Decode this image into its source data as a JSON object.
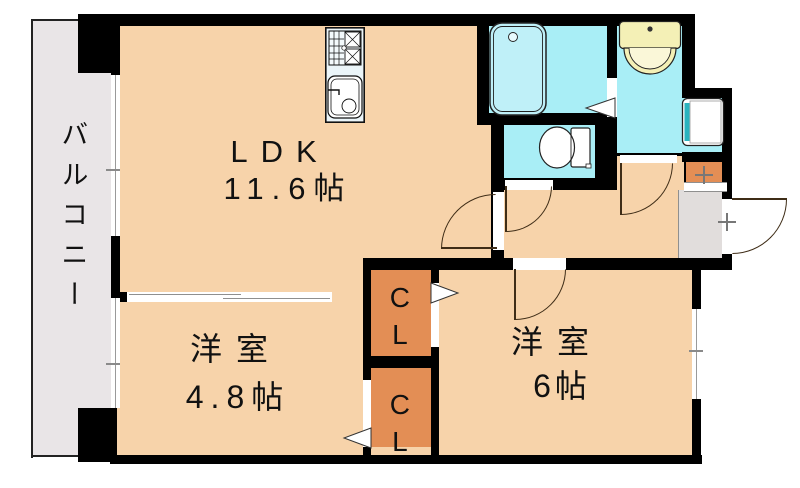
{
  "document": {
    "type": "floor-plan"
  },
  "rooms": {
    "balcony": {
      "label": "バルコニー"
    },
    "ldk": {
      "label": "LDK",
      "size": "11.6帖"
    },
    "bedroom_west": {
      "label": "洋室",
      "size": "4.8帖"
    },
    "bedroom_east": {
      "label": "洋室",
      "size": "6帖"
    },
    "closet_upper": {
      "label": "CL"
    },
    "closet_lower": {
      "label": "CL"
    }
  },
  "fixtures": {
    "kitchen": "kitchen-unit",
    "bathtub": "bathtub",
    "washbasin": "washbasin-vanity",
    "toilet": "toilet",
    "washing_machine_pan": "washing-machine-pan",
    "shoe_cabinet": "shoe-cabinet",
    "entrance_door": "entrance-door"
  },
  "colors": {
    "room": "#F7D3AA",
    "wet": "#A9EEF6",
    "balcony": "#E9E5E7",
    "entrance": "#E1DDDC",
    "closet": "#E38E55",
    "basin": "#F4F0B6",
    "teal": "#2BB3BE",
    "kitchen": "#EBF5F9",
    "tub": "#BFF0F8",
    "wall": "#000000",
    "arc": "#3F2D17"
  }
}
